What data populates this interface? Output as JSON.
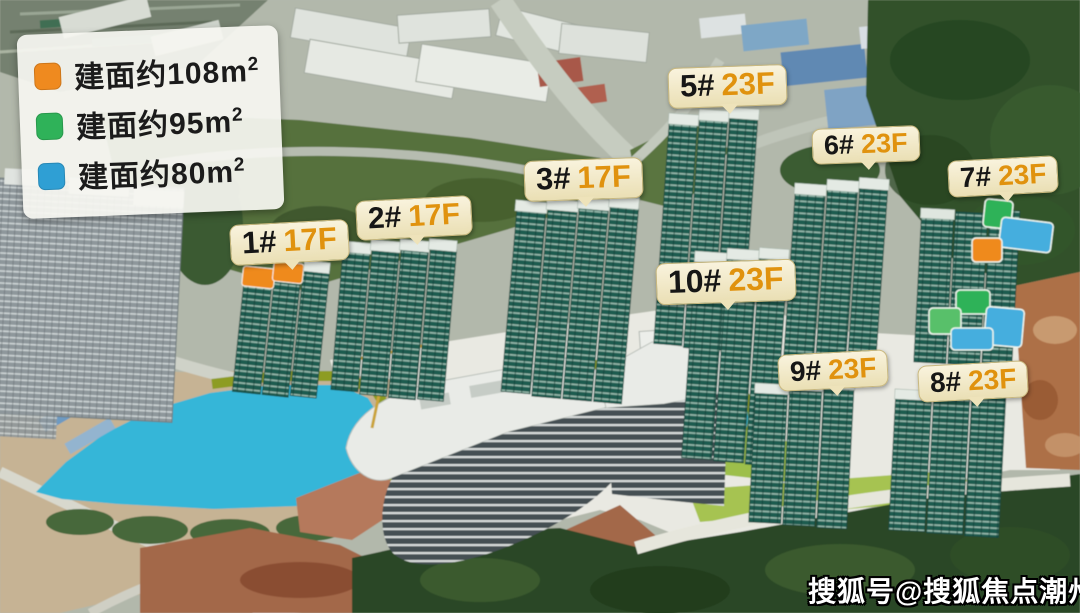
{
  "legend": {
    "items": [
      {
        "text": "建面约108m",
        "sup": "2",
        "color": "#ef8a1f"
      },
      {
        "text": "建面约95m",
        "sup": "2",
        "color": "#2fb259"
      },
      {
        "text": "建面约80m",
        "sup": "2",
        "color": "#2f9fd4"
      }
    ]
  },
  "buildings": [
    {
      "num": "1#",
      "floors": "17F"
    },
    {
      "num": "2#",
      "floors": "17F"
    },
    {
      "num": "3#",
      "floors": "17F"
    },
    {
      "num": "5#",
      "floors": "23F"
    },
    {
      "num": "6#",
      "floors": "23F"
    },
    {
      "num": "7#",
      "floors": "23F"
    },
    {
      "num": "10#",
      "floors": "23F"
    },
    {
      "num": "9#",
      "floors": "23F"
    },
    {
      "num": "8#",
      "floors": "23F"
    }
  ],
  "watermark": {
    "text": "搜狐号@搜狐焦点潮州站"
  },
  "colors": {
    "floor_text": "#e0920e",
    "lake": "#36b6d8",
    "lawn": "#9dbf4c",
    "tower": "#1f5b50"
  }
}
